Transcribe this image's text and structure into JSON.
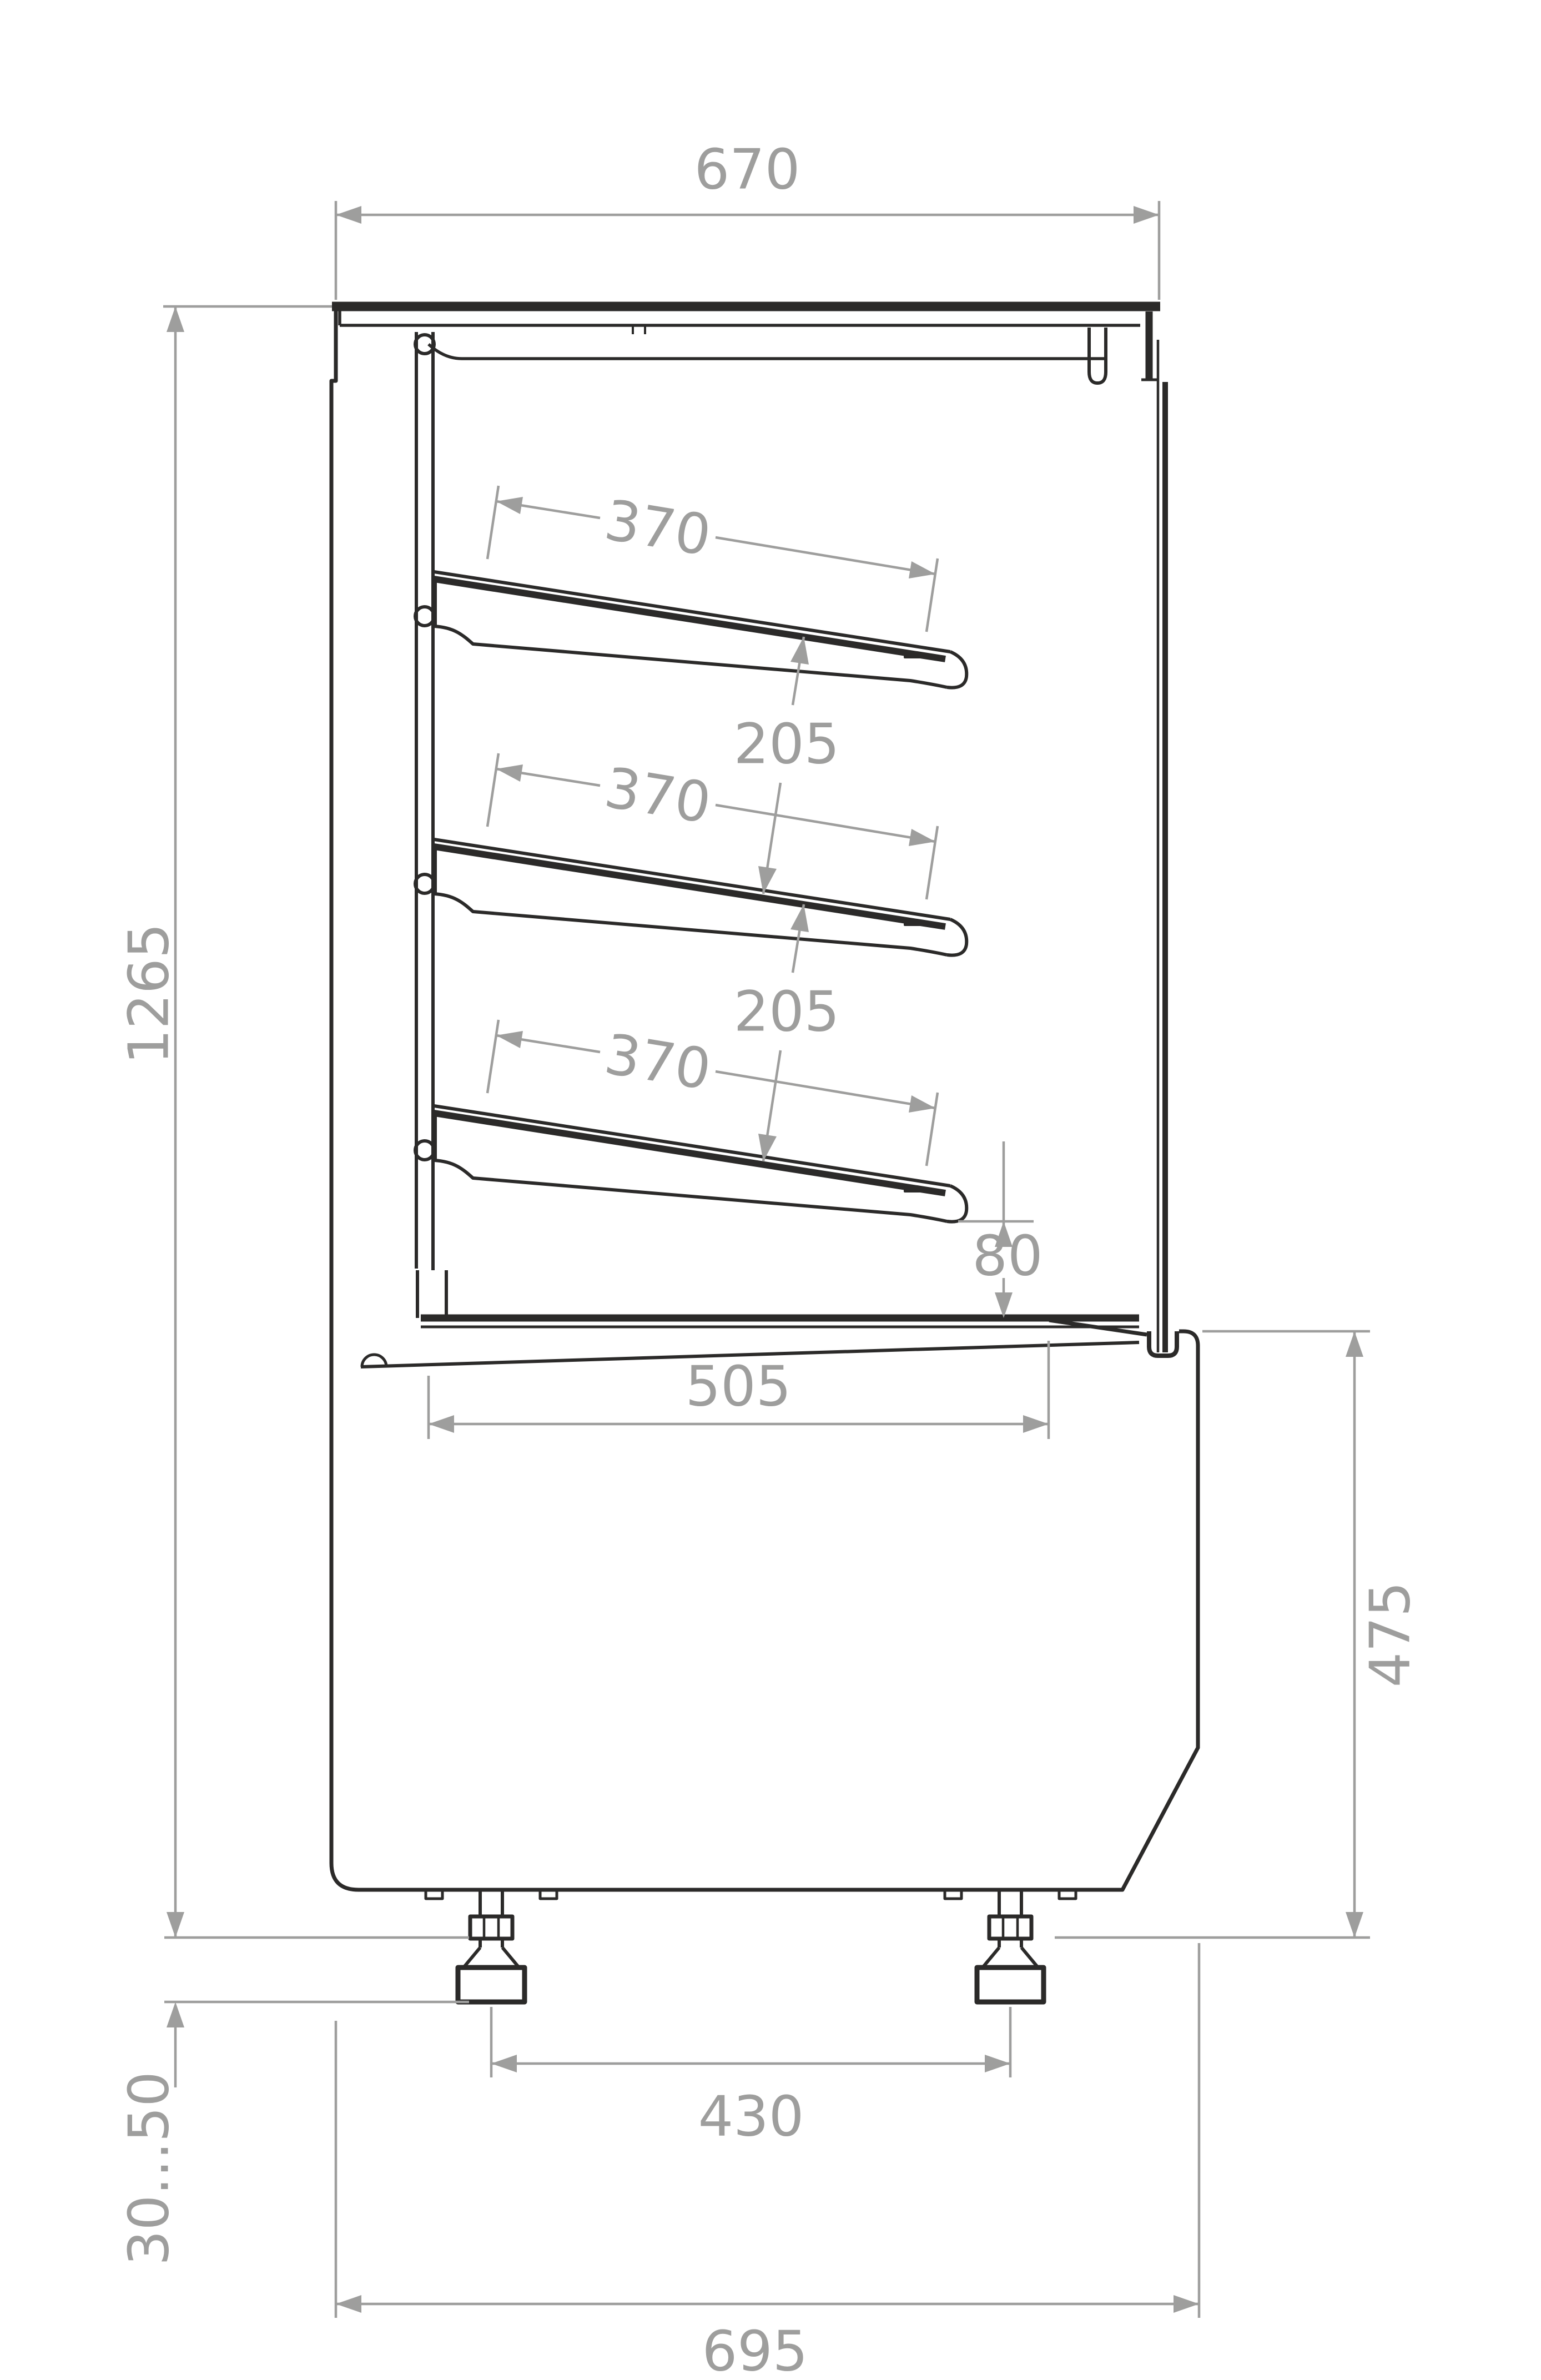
{
  "drawing": {
    "colors": {
      "line": "#2b2a29",
      "dimension": "#9e9e9d",
      "background": "#ffffff"
    },
    "dimensions": {
      "top_width": "670",
      "shelf_depth": [
        "370",
        "370",
        "370"
      ],
      "shelf_spacing": [
        "205",
        "205"
      ],
      "front_gap": "80",
      "deck_depth": "505",
      "overall_height": "1265",
      "base_height": "475",
      "feet_spacing": "430",
      "base_depth": "695",
      "feet_adjust_range": "30...50"
    }
  }
}
